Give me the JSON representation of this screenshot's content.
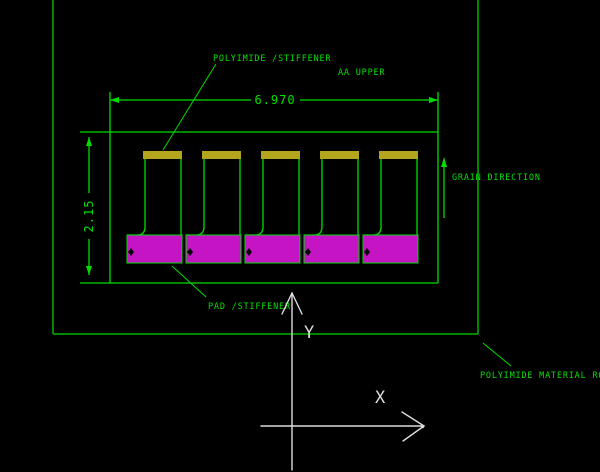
{
  "drawing": {
    "labels": {
      "top_leader": "POLYIMIDE /STIFFENER",
      "upper_note": "AA UPPER",
      "grain": "GRAIN DIRECTION",
      "bottom_leader": "PAD /STIFFENER",
      "material_roll": "POLYIMIDE MATERIAL ROLL"
    },
    "dimensions": {
      "width": "6.970",
      "height": "2.15"
    },
    "axes": {
      "x": "X",
      "y": "Y"
    },
    "unit_count": 5,
    "colors": {
      "background": "#000000",
      "line_green": "#00dd00",
      "line_green_dim": "#00b400",
      "text_green": "#00e000",
      "stiffener_yellow": "#b3a51c",
      "pad_magenta": "#c414c4",
      "axis_white": "#dcdcdc"
    }
  }
}
